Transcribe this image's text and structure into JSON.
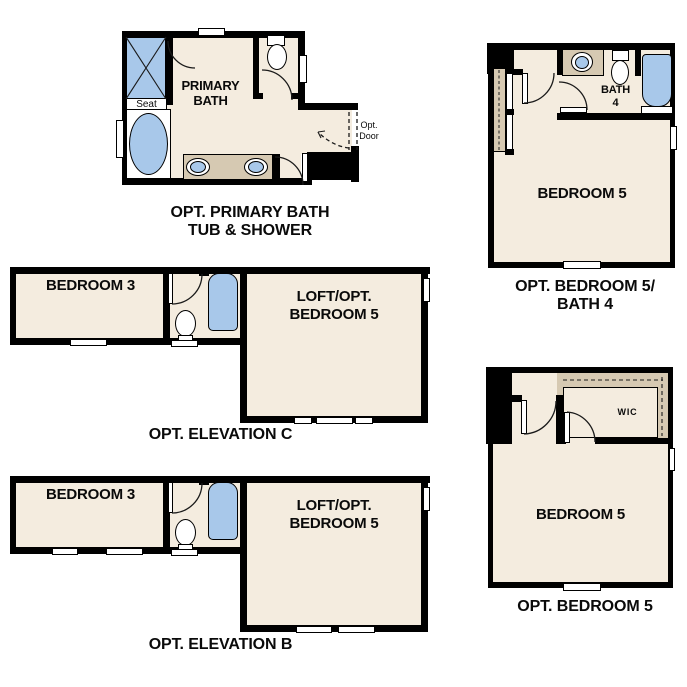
{
  "colors": {
    "floor": "#f4ecdf",
    "wall": "#000000",
    "fixture_blue": "#a8c8ea",
    "counter_tan": "#d6c9b2",
    "background": "#ffffff"
  },
  "plans": {
    "primary_bath": {
      "caption_line1": "OPT. PRIMARY BATH",
      "caption_line2": "TUB & SHOWER",
      "room_line1": "PRIMARY",
      "room_line2": "BATH",
      "seat": "Seat",
      "opt_door_line1": "Opt.",
      "opt_door_line2": "Door"
    },
    "elevation_c": {
      "caption": "OPT. ELEVATION C",
      "bedroom3": "BEDROOM 3",
      "loft_line1": "LOFT/OPT.",
      "loft_line2": "BEDROOM 5"
    },
    "elevation_b": {
      "caption": "OPT. ELEVATION B",
      "bedroom3": "BEDROOM 3",
      "loft_line1": "LOFT/OPT.",
      "loft_line2": "BEDROOM 5"
    },
    "bedroom5_bath4": {
      "caption_line1": "OPT. BEDROOM 5/",
      "caption_line2": "BATH 4",
      "bedroom": "BEDROOM 5",
      "bath_line1": "BATH",
      "bath_line2": "4"
    },
    "bedroom5_wic": {
      "caption": "OPT. BEDROOM 5",
      "bedroom": "BEDROOM 5",
      "wic": "WIC"
    }
  }
}
